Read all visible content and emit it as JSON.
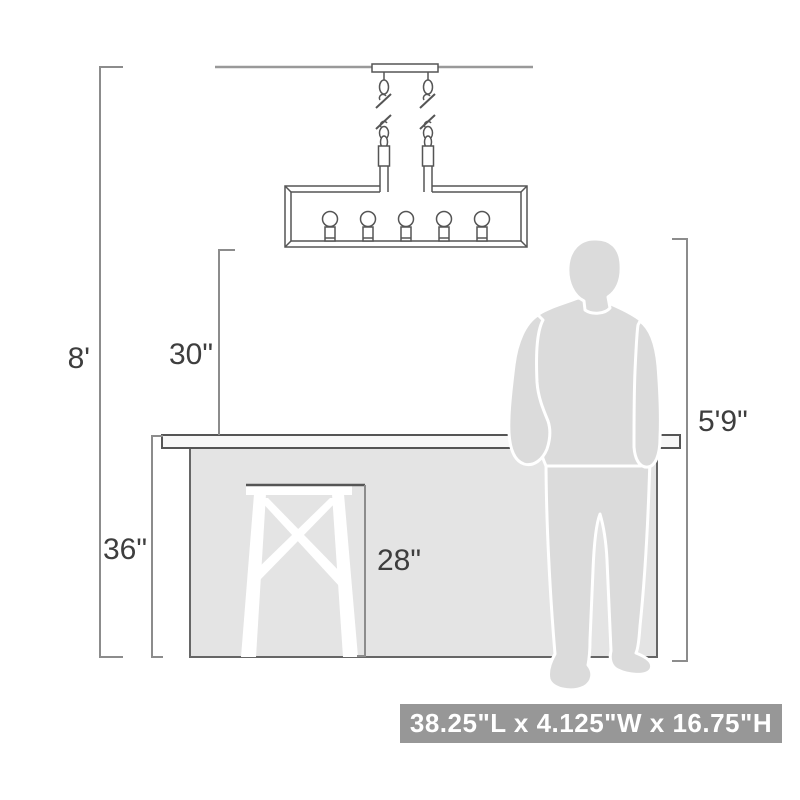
{
  "diagram": {
    "title": "chandelier-mounting-height-diagram",
    "dimension_labels": {
      "ceiling_height": "8'",
      "fixture_bottom_to_counter": "30\"",
      "counter_height": "36\"",
      "stool_seat_height": "28\"",
      "person_height": "5'9\""
    },
    "size_badge": {
      "text": "38.25\"L x 4.125\"W x 16.75\"H"
    },
    "objects": {
      "fixture": "linear-chandelier-5-light",
      "scale_references": [
        "kitchen-counter",
        "bar-stool",
        "standing-person"
      ]
    },
    "colors": {
      "outline": "#555555",
      "ceiling_line": "#999999",
      "dimension_line": "#8c8c8c",
      "label_text": "#3e3e3e",
      "counter_fill": "#e4e4e4",
      "countertop_fill": "#f7f7f7",
      "silhouette_fill": "#dbdbdb",
      "stool_fill": "#ffffff",
      "badge_background": "#979797",
      "badge_text": "#ffffff"
    }
  }
}
